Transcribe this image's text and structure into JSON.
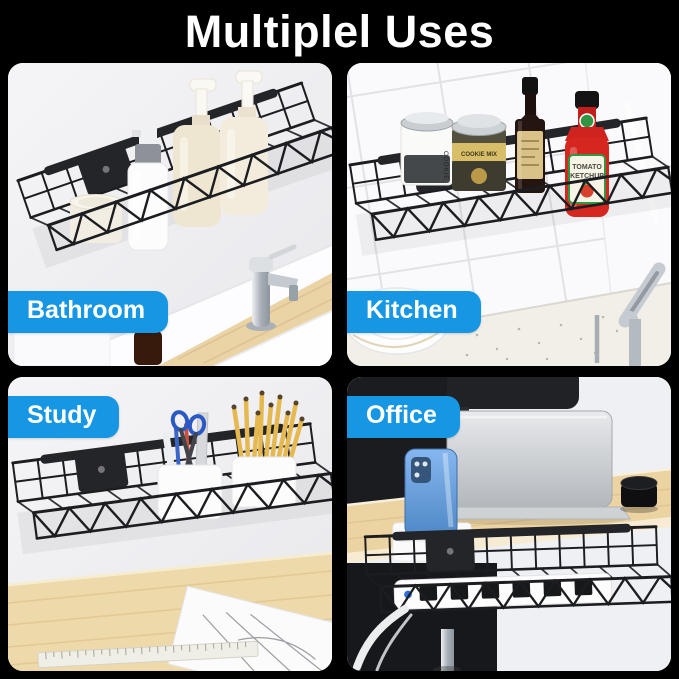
{
  "title": "Multiplel Uses",
  "colors": {
    "background": "#000000",
    "badge_blue": "#1796E4",
    "badge_text": "#FFFFFF",
    "wire_rack_black": "#1C1D20",
    "wood_desk": "#EAD3A5"
  },
  "sections": [
    {
      "id": "bathroom",
      "label": "Bathroom",
      "badge_corner": "bottom-left"
    },
    {
      "id": "kitchen",
      "label": "Kitchen",
      "badge_corner": "bottom-left"
    },
    {
      "id": "study",
      "label": "Study",
      "badge_corner": "top-left"
    },
    {
      "id": "office",
      "label": "Office",
      "badge_corner": "top-left"
    }
  ],
  "product_labels": {
    "cookie_jar": "COOKIE",
    "spice_jar": "COOKIE MIX",
    "ketchup_line1": "TOMATO",
    "ketchup_line2": "KETCHUP"
  }
}
